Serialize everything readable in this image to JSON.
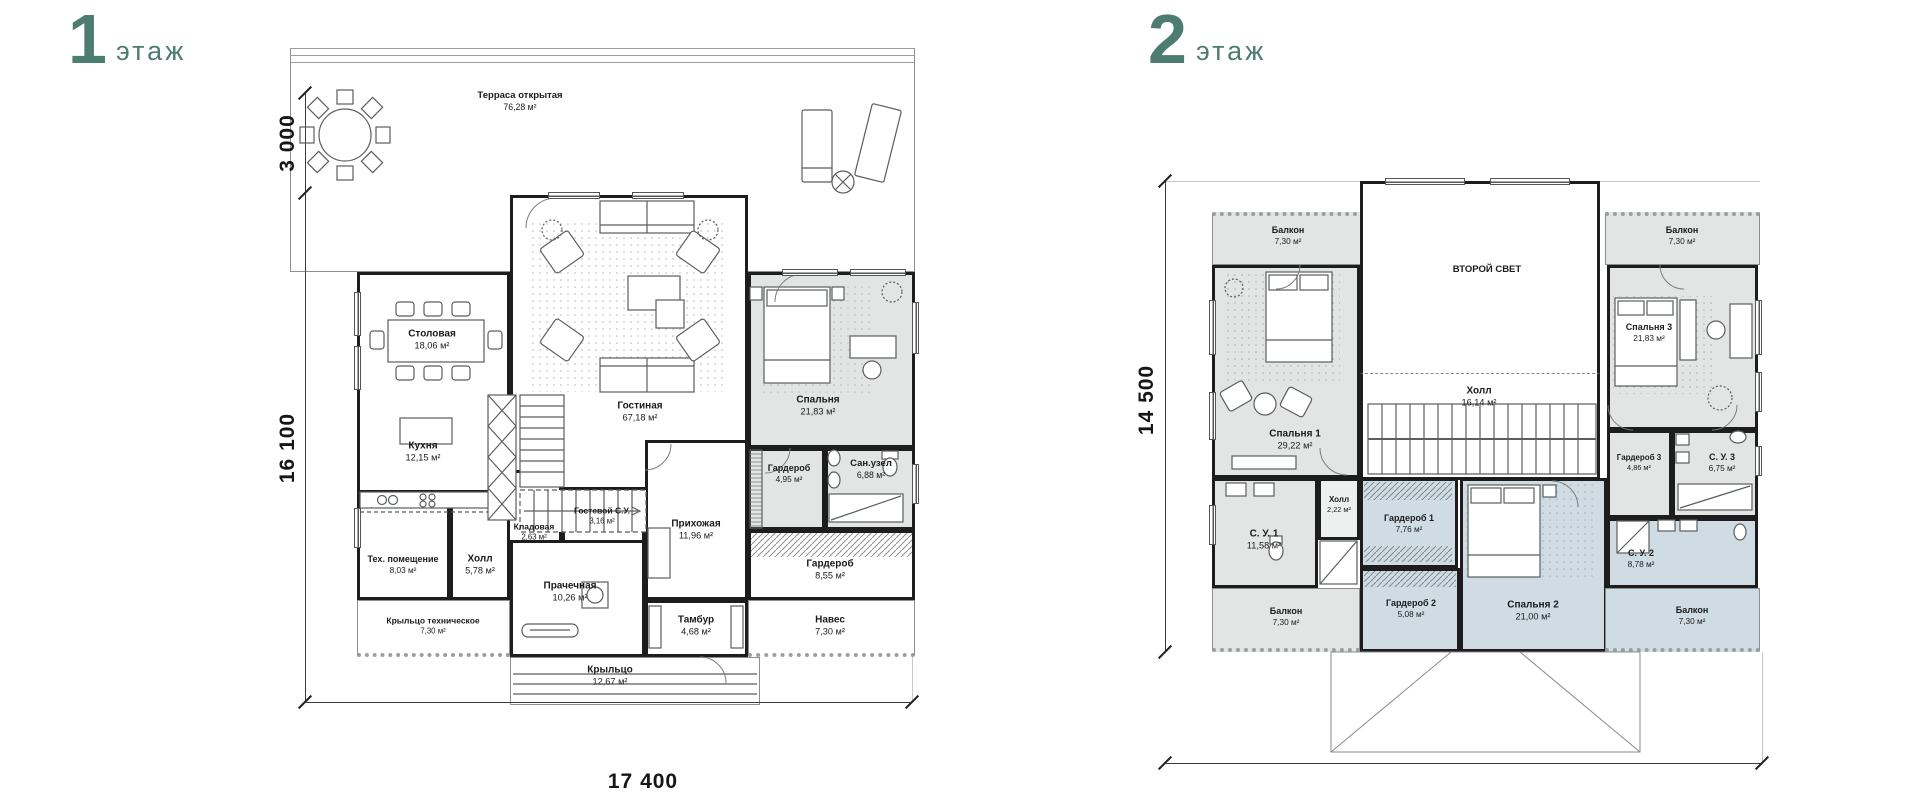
{
  "palette": {
    "teal": "#4d7c70",
    "wall": "#1d1d1d",
    "white": "#ffffff",
    "gray": "#e3e5e4",
    "blue": "#cfdce4",
    "hall": "#eef0ef"
  },
  "floor1": {
    "title_number": "1",
    "title_word": "этаж",
    "dims": {
      "terrace_depth": "3 000",
      "height": "16 100",
      "width": "17 400"
    },
    "rooms": [
      {
        "id": "terrace",
        "name": "Терраса открытая",
        "area": "76,28 м²",
        "x": 60,
        "y": 8,
        "w": 625,
        "h": 224,
        "fill": "white",
        "wall": "thin",
        "lx": 290,
        "ly": 62,
        "fs": 9.5
      },
      {
        "id": "dining-kitchen-block",
        "x": 127,
        "y": 232,
        "w": 153,
        "h": 255,
        "fill": "white",
        "wall": "thick"
      },
      {
        "id": "dining",
        "name": "Столовая",
        "area": "18,06 м²",
        "lx": 202,
        "ly": 300
      },
      {
        "id": "kitchen",
        "name": "Кухня",
        "area": "12,15 м²",
        "lx": 193,
        "ly": 412
      },
      {
        "id": "living",
        "name": "Гостиная",
        "area": "67,18 м²",
        "x": 280,
        "y": 155,
        "w": 238,
        "h": 345,
        "fill": "white",
        "wall": "thick",
        "lx": 410,
        "ly": 372
      },
      {
        "id": "bedroom",
        "name": "Спальня",
        "area": "21,83 м²",
        "x": 518,
        "y": 232,
        "w": 167,
        "h": 176,
        "fill": "gray",
        "wall": "thick",
        "lx": 588,
        "ly": 366
      },
      {
        "id": "wardrobe-small",
        "name": "Гардероб",
        "area": "4,95 м²",
        "x": 518,
        "y": 408,
        "w": 77,
        "h": 82,
        "fill": "gray",
        "wall": "thick",
        "lx": 559,
        "ly": 434,
        "fs": 9
      },
      {
        "id": "sanuzel",
        "name": "Сан.узел",
        "area": "6,88 м²",
        "x": 595,
        "y": 408,
        "w": 90,
        "h": 82,
        "fill": "gray",
        "wall": "thick",
        "lx": 641,
        "ly": 430,
        "fs": 9.5
      },
      {
        "id": "wardrobe-big",
        "name": "Гардероб",
        "area": "8,55 м²",
        "x": 518,
        "y": 490,
        "w": 167,
        "h": 70,
        "fill": "white",
        "wall": "thick",
        "lx": 600,
        "ly": 530
      },
      {
        "id": "canopy",
        "name": "Навес",
        "area": "7,30 м²",
        "x": 518,
        "y": 560,
        "w": 167,
        "h": 57,
        "fill": "white",
        "wall": "thin",
        "cls": "dot-bottom",
        "lx": 600,
        "ly": 586
      },
      {
        "id": "entry-hall",
        "name": "Прихожая",
        "area": "11,96 м²",
        "x": 415,
        "y": 400,
        "w": 103,
        "h": 160,
        "fill": "white",
        "wall": "thick",
        "lx": 466,
        "ly": 490
      },
      {
        "id": "guest-wc",
        "name": "Гостевой С.У.",
        "area": "3,16 м²",
        "x": 332,
        "y": 447,
        "w": 83,
        "h": 65,
        "fill": "white",
        "wall": "thick",
        "lx": 372,
        "ly": 476,
        "fs": 8.5
      },
      {
        "id": "pantry",
        "name": "Кладовая",
        "area": "2,63 м²",
        "x": 277,
        "y": 430,
        "w": 55,
        "h": 82,
        "fill": "white",
        "wall": "thick",
        "lx": 304,
        "ly": 492,
        "fs": 8.5
      },
      {
        "id": "tech-room",
        "name": "Тех. помещение",
        "area": "8,03 м²",
        "x": 127,
        "y": 450,
        "w": 93,
        "h": 110,
        "fill": "white",
        "wall": "thick",
        "lx": 173,
        "ly": 525,
        "fs": 9
      },
      {
        "id": "hall1",
        "name": "Холл",
        "area": "5,78 м²",
        "x": 220,
        "y": 450,
        "w": 60,
        "h": 110,
        "fill": "white",
        "wall": "thick",
        "lx": 250,
        "ly": 525
      },
      {
        "id": "laundry",
        "name": "Прачечная",
        "area": "10,26 м²",
        "x": 280,
        "y": 500,
        "w": 135,
        "h": 117,
        "fill": "white",
        "wall": "thick",
        "lx": 340,
        "ly": 552
      },
      {
        "id": "tech-porch",
        "name": "Крыльцо техническое",
        "area": "7,30 м²",
        "x": 127,
        "y": 560,
        "w": 153,
        "h": 57,
        "fill": "white",
        "wall": "thin",
        "cls": "dot-bottom",
        "lx": 203,
        "ly": 586,
        "fs": 8.5
      },
      {
        "id": "vestibule",
        "name": "Тамбур",
        "area": "4,68 м²",
        "x": 415,
        "y": 560,
        "w": 103,
        "h": 57,
        "fill": "white",
        "wall": "thick",
        "lx": 466,
        "ly": 586
      },
      {
        "id": "porch",
        "name": "Крыльцо",
        "area": "12,67 м²",
        "x": 280,
        "y": 617,
        "w": 250,
        "h": 48,
        "fill": "white",
        "wall": "thin",
        "lx": 380,
        "ly": 636
      }
    ]
  },
  "floor2": {
    "title_number": "2",
    "title_word": "этаж",
    "dims": {
      "height": "14 500",
      "width": "17 400"
    },
    "rooms": [
      {
        "id": "balcony-tl",
        "name": "Балкон",
        "area": "7,30 м²",
        "x": 112,
        "y": 212,
        "w": 153,
        "h": 53,
        "fill": "gray",
        "wall": "thin",
        "cls": "dot-top",
        "lx": 188,
        "ly": 236,
        "fs": 9
      },
      {
        "id": "balcony-tr",
        "name": "Балкон",
        "area": "7,30 м²",
        "x": 505,
        "y": 212,
        "w": 155,
        "h": 53,
        "fill": "gray",
        "wall": "thin",
        "cls": "dot-top",
        "lx": 582,
        "ly": 236,
        "fs": 9
      },
      {
        "id": "void",
        "name": "ВТОРОЙ СВЕТ",
        "x": 260,
        "y": 181,
        "w": 240,
        "h": 192,
        "fill": "white",
        "wall": "thick",
        "cls": "open-bottom",
        "lx": 387,
        "ly": 270,
        "fs": 9.5
      },
      {
        "id": "hall2",
        "name": "Холл",
        "area": "16,14 м²",
        "x": 260,
        "y": 373,
        "w": 240,
        "h": 107,
        "fill": "white",
        "wall": "thick",
        "cls": "open-top",
        "lx": 379,
        "ly": 397
      },
      {
        "id": "bedroom1",
        "name": "Спальня 1",
        "area": "29,22 м²",
        "x": 112,
        "y": 265,
        "w": 148,
        "h": 213,
        "fill": "gray",
        "wall": "thick",
        "lx": 195,
        "ly": 440
      },
      {
        "id": "wc1",
        "name": "С. У. 1",
        "area": "11,58 м²",
        "x": 112,
        "y": 478,
        "w": 106,
        "h": 110,
        "fill": "gray",
        "wall": "thick",
        "lx": 164,
        "ly": 540
      },
      {
        "id": "hall-small",
        "name": "Холл",
        "area": "2,22 м²",
        "x": 218,
        "y": 478,
        "w": 42,
        "h": 62,
        "fill": "hall",
        "wall": "thick",
        "lx": 239,
        "ly": 505,
        "fs": 8
      },
      {
        "id": "balcony-bl",
        "name": "Балкон",
        "area": "7,30 м²",
        "x": 112,
        "y": 588,
        "w": 148,
        "h": 64,
        "fill": "gray",
        "wall": "thin",
        "cls": "dot-bottom",
        "lx": 186,
        "ly": 617,
        "fs": 9
      },
      {
        "id": "wardrobe1",
        "name": "Гардероб 1",
        "area": "7,76 м²",
        "x": 260,
        "y": 478,
        "w": 98,
        "h": 90,
        "fill": "blue",
        "wall": "thick",
        "lx": 309,
        "ly": 524,
        "fs": 9
      },
      {
        "id": "wardrobe2",
        "name": "Гардероб 2",
        "area": "5,08 м²",
        "x": 260,
        "y": 568,
        "w": 100,
        "h": 84,
        "fill": "blue",
        "wall": "thick",
        "lx": 311,
        "ly": 609,
        "fs": 9
      },
      {
        "id": "bedroom2",
        "name": "Спальня 2",
        "area": "21,00 м²",
        "x": 360,
        "y": 478,
        "w": 147,
        "h": 174,
        "fill": "blue",
        "wall": "thick",
        "lx": 433,
        "ly": 611
      },
      {
        "id": "bedroom3",
        "name": "Спальня 3",
        "area": "21,83 м²",
        "x": 507,
        "y": 265,
        "w": 151,
        "h": 165,
        "fill": "gray",
        "wall": "thick",
        "lx": 549,
        "ly": 333,
        "fs": 9
      },
      {
        "id": "wardrobe3",
        "name": "Гардероб 3",
        "area": "4,86 м²",
        "x": 507,
        "y": 430,
        "w": 65,
        "h": 88,
        "fill": "gray",
        "wall": "thick",
        "lx": 539,
        "ly": 463,
        "fs": 8
      },
      {
        "id": "wc3",
        "name": "С. У. 3",
        "area": "6,75 м²",
        "x": 572,
        "y": 430,
        "w": 86,
        "h": 88,
        "fill": "gray",
        "wall": "thick",
        "lx": 622,
        "ly": 463,
        "fs": 9
      },
      {
        "id": "wc2",
        "name": "С. У. 2",
        "area": "8,78 м²",
        "x": 507,
        "y": 518,
        "w": 151,
        "h": 70,
        "fill": "blue",
        "wall": "thick",
        "lx": 541,
        "ly": 559,
        "fs": 9
      },
      {
        "id": "balcony-br",
        "name": "Балкон",
        "area": "7,30 м²",
        "x": 505,
        "y": 588,
        "w": 155,
        "h": 64,
        "fill": "blue",
        "wall": "thin",
        "cls": "dot-bottom",
        "lx": 592,
        "ly": 616,
        "fs": 9
      }
    ]
  }
}
